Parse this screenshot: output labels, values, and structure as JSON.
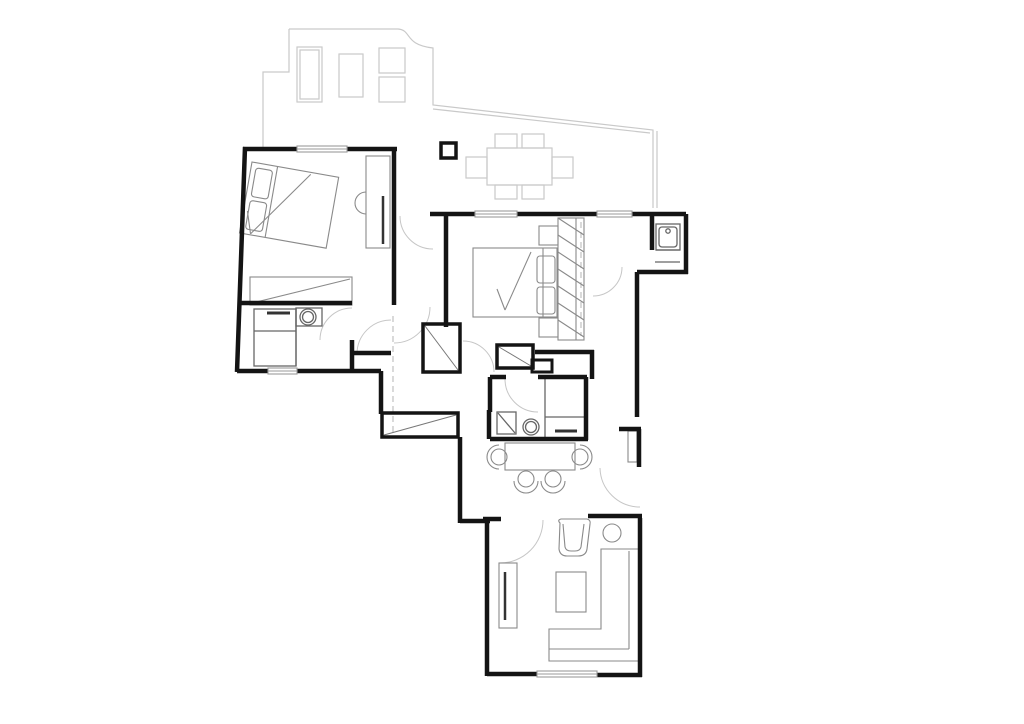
{
  "title": "apartment-floor-plan",
  "canvas": {
    "width": 1024,
    "height": 724
  },
  "colors": {
    "background": "#ffffff",
    "wall": "#141414",
    "terrace": "#c9c9c9",
    "furniture": "#8a8a8a",
    "fixture": "#666666",
    "window": "#9a9a9a",
    "door_arc": "#c6c6c6",
    "dashed": "#c0c0c0",
    "accent_dark": "#333333",
    "closet_diag": "#777777"
  },
  "rooms": [
    {
      "name": "terrace",
      "features": [
        "sun-lounger",
        "side-table",
        "two-stools",
        "outdoor-dining-table-6-chairs",
        "parapet"
      ]
    },
    {
      "name": "bedroom-1",
      "features": [
        "double-bed-rotated",
        "two-pillows",
        "dresser",
        "wardrobe",
        "window"
      ]
    },
    {
      "name": "bathroom-1",
      "features": [
        "shower",
        "washbasin",
        "towel-rail",
        "window"
      ]
    },
    {
      "name": "hallway",
      "features": [
        "closet-a",
        "closet-b",
        "dashed-ceiling-line"
      ]
    },
    {
      "name": "bedroom-2",
      "features": [
        "double-bed",
        "two-pillows",
        "nightstands",
        "hatched-wardrobe",
        "windows"
      ]
    },
    {
      "name": "bathroom-2",
      "features": [
        "shower",
        "washbasin",
        "towel-rail",
        "duct-shaft"
      ]
    },
    {
      "name": "dining-area",
      "features": [
        "table",
        "four-chairs"
      ]
    },
    {
      "name": "corridor",
      "features": [
        "radiator",
        "doors"
      ]
    },
    {
      "name": "utility-niche",
      "features": [
        "sink"
      ]
    },
    {
      "name": "living-room",
      "features": [
        "l-shaped-sofa",
        "armchair",
        "round-side-table",
        "coffee-table",
        "tv-cabinet",
        "window"
      ]
    }
  ],
  "structure": {
    "column_count": 1,
    "window_count": 5,
    "door_arc_count": 9
  }
}
